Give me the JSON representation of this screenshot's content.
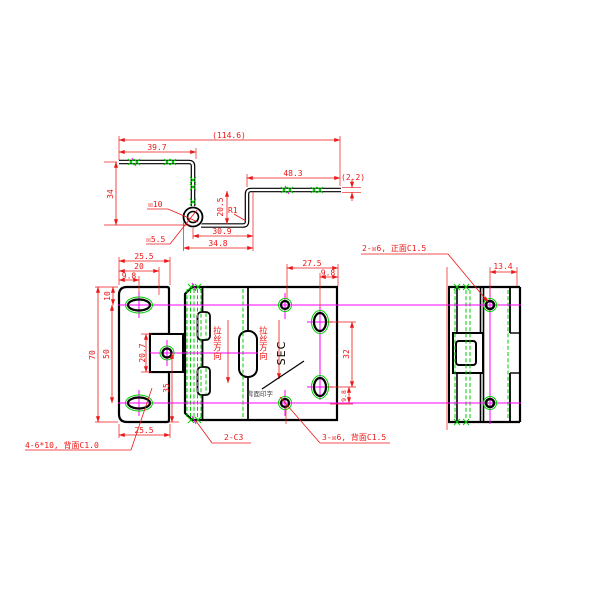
{
  "canvas": {
    "width": 600,
    "height": 600,
    "background": "#ffffff"
  },
  "colors": {
    "outline": "#000000",
    "dimension": "#ee1616",
    "centerline": "#ff00ff",
    "hatch": "#00cc00",
    "note_text": "#444444"
  },
  "views": {
    "profile": {
      "dims": {
        "overall": "(114.6)",
        "top_flange": "39.7",
        "height": "34",
        "right_flange": "48.3",
        "thickness": "(2.2)",
        "step_drop": "20.5",
        "bend_radius": "R1",
        "curl_outer": "☒10",
        "curl_inner": "☒5.5",
        "bottom_offset": "30.9",
        "bottom_total": "34.8"
      }
    },
    "front": {
      "dims": {
        "top_width": "25.5",
        "top_mid": "20",
        "top_slot": "9.8",
        "slot_offset": "10",
        "height": "70",
        "slot_spacing": "50",
        "tab_height": "20.7",
        "lower_span": "35",
        "bottom_width": "25.5"
      },
      "note_slots": "4-6*10, 背面C1.0"
    },
    "face": {
      "dims": {
        "hole_offset": "27.5",
        "oval_offset": "9.8",
        "oval_spacing": "32",
        "oval_to_hole": "9.8"
      },
      "brush_direction_1": "拉丝方向",
      "brush_direction_2": "拉丝方向",
      "section_label": "SEC",
      "back_print": "背面印字",
      "note_chamfer": "2-C3",
      "note_holes": "3-☒6, 背面C1.5"
    },
    "side": {
      "dims": {
        "width": "13.4"
      },
      "note_holes": "2-☒6, 正面C1.5"
    }
  }
}
